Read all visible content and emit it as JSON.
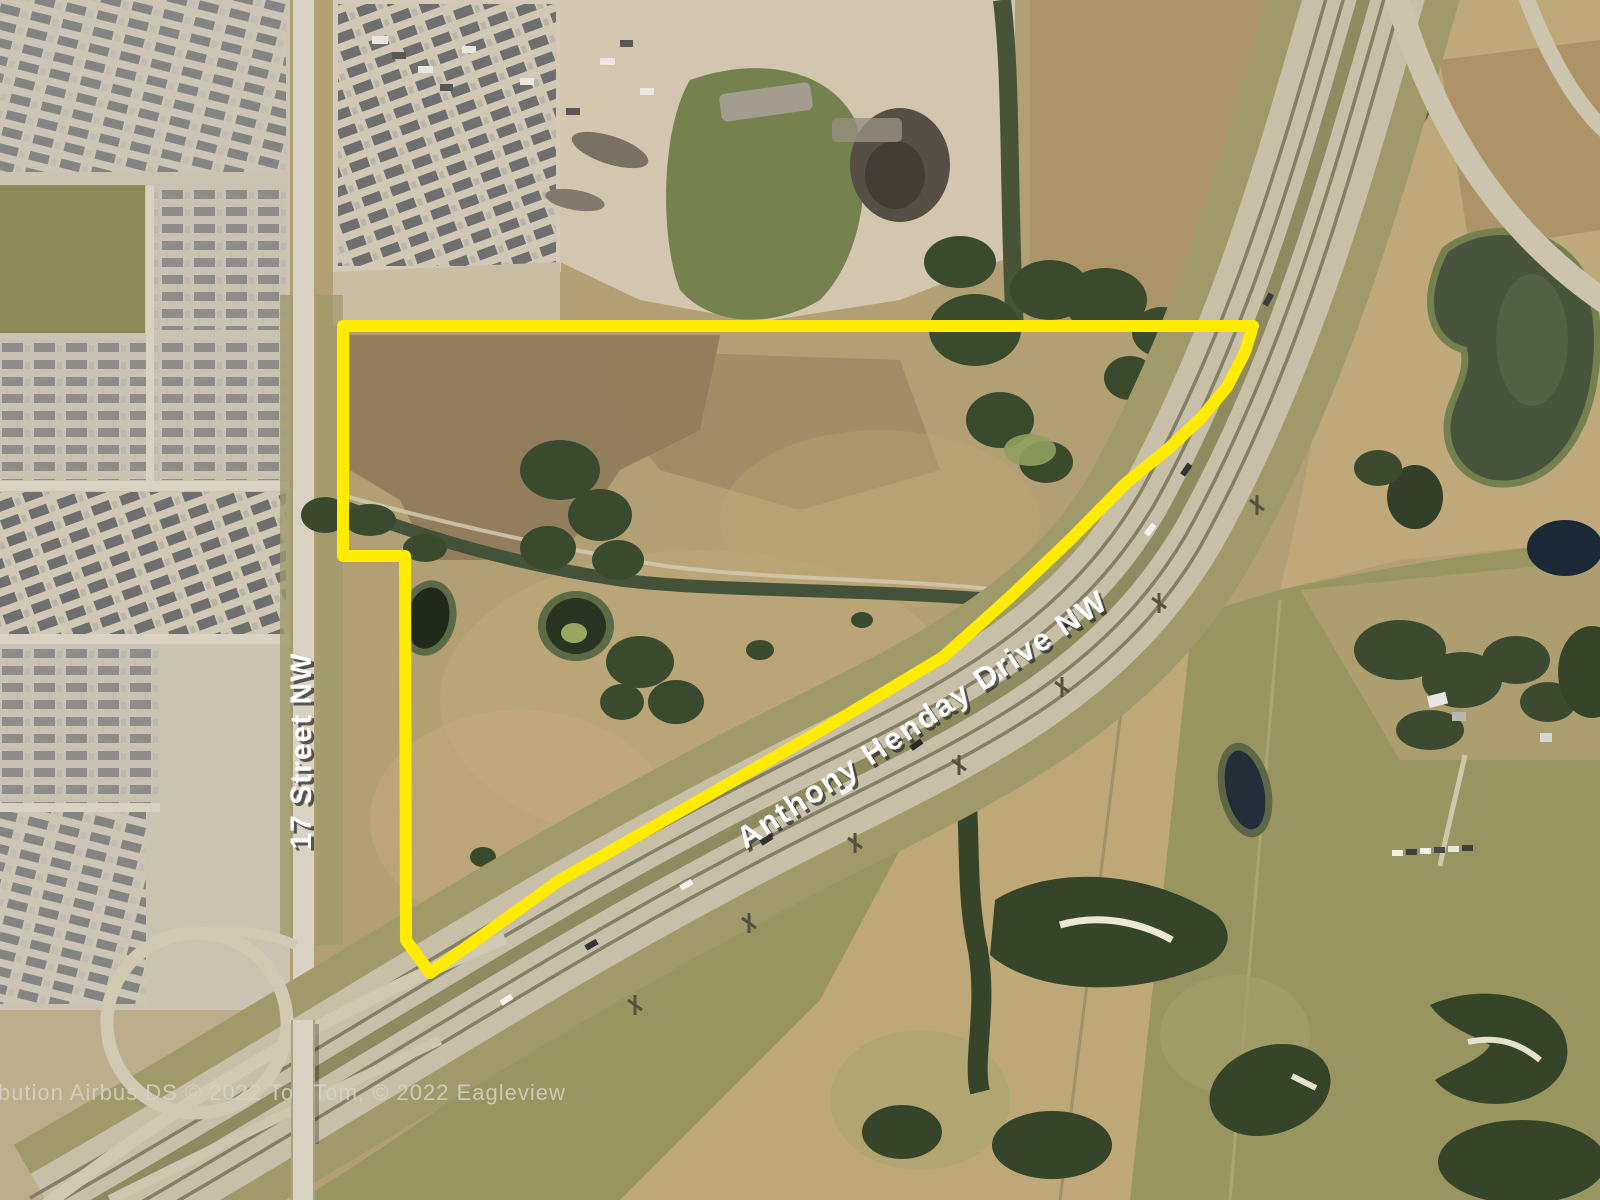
{
  "map": {
    "street_label": "17 Street NW",
    "highway_label": "Anthony Henday Drive NW",
    "attribution": "ibution Airbus DS © 2022 TomTom, © 2022 Eagleview",
    "label_text_color": "#ffffff",
    "label_shadow_color": "#2b2b2b",
    "attribution_color": "#d6d3cb",
    "parcel": {
      "outline_color": "#ffec00",
      "points": "343,326 1253,326 1245,352 1227,387 1201,418 1168,449 1126,483 1073,537 1010,597 943,657 820,731 700,800 560,880 430,973 406,940 405,556 343,556"
    }
  }
}
